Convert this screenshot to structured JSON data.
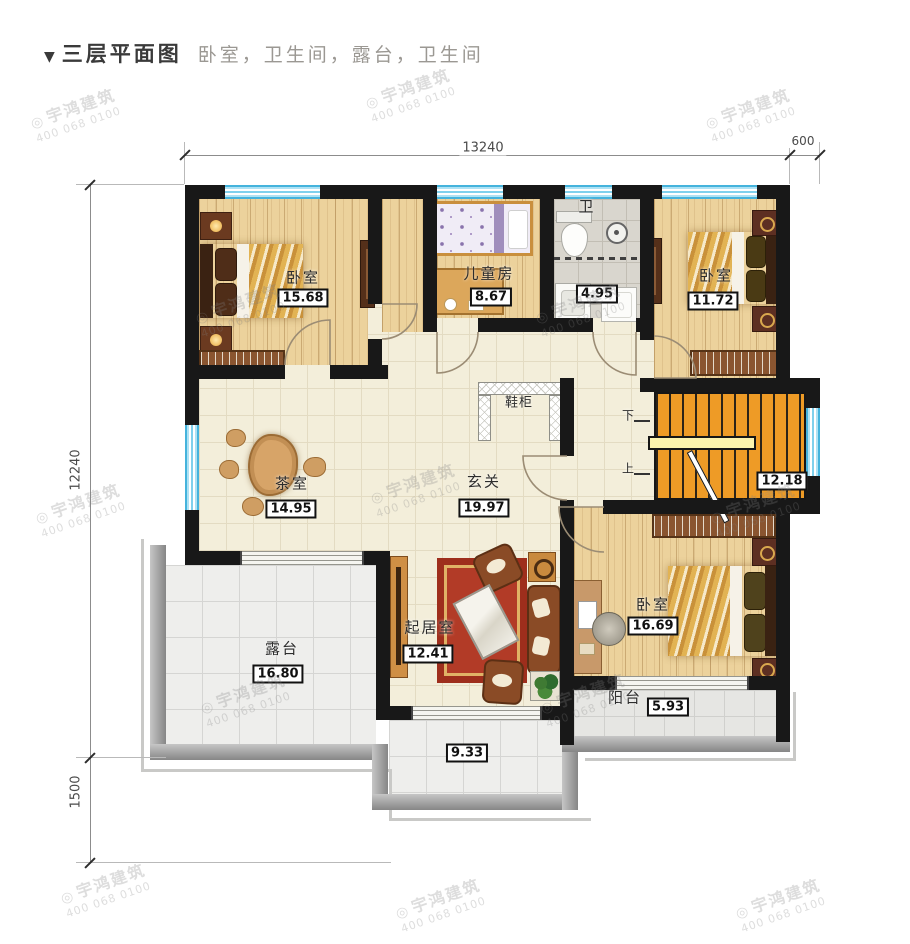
{
  "header": {
    "marker": "▼",
    "title": "三层平面图",
    "subtitle": "卧室，卫生间，露台，卫生间"
  },
  "watermark": {
    "logo": "◎",
    "brand": "宇鸿建筑",
    "phone": "400 068 0100"
  },
  "dimensions": {
    "top_width": "13240",
    "top_right": "600",
    "left_height": "12240",
    "left_lower": "1500"
  },
  "stairs": {
    "area": "12.18",
    "down_label": "下",
    "up_label": "上"
  },
  "rooms": {
    "bedroom_tl": {
      "name": "卧室",
      "area": "15.68"
    },
    "kids_room": {
      "name": "儿童房",
      "area": "8.67"
    },
    "bathroom": {
      "name": "卫",
      "area": "4.95"
    },
    "bedroom_tr": {
      "name": "卧室",
      "area": "11.72"
    },
    "tea_room": {
      "name": "茶室",
      "area": "14.95"
    },
    "foyer": {
      "name": "玄关",
      "area": "19.97"
    },
    "shoe_cabinet": {
      "name": "鞋柜"
    },
    "living_room": {
      "name": "起居室",
      "area": "12.41"
    },
    "bedroom_br": {
      "name": "卧室",
      "area": "16.69"
    },
    "terrace": {
      "name": "露台",
      "area": "16.80"
    },
    "terrace_lower": {
      "area": "9.33"
    },
    "balcony": {
      "name": "阳台",
      "area": "5.93"
    }
  },
  "colors": {
    "wall": "#181818",
    "window": "#7fd0ec",
    "stairs": "#ee9b26",
    "wood": "#ecd29c"
  }
}
